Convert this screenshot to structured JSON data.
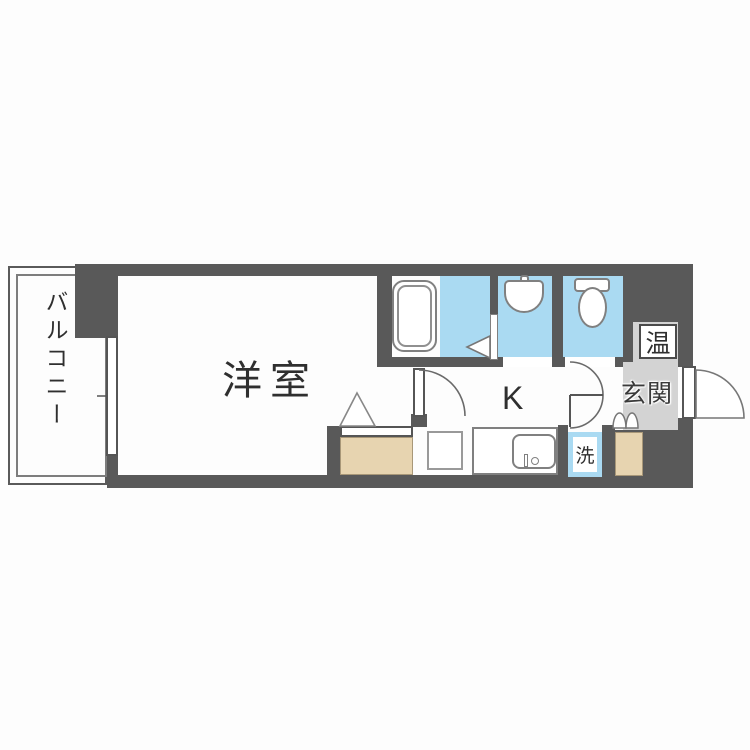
{
  "plan": {
    "type": "japanese-apartment-floorplan",
    "rooms": {
      "balcony_label": "バルコニー",
      "western_room_label": "洋室",
      "kitchen_label": "K",
      "entrance_label": "玄関"
    },
    "fixtures": {
      "water_heater_label": "温",
      "laundry_label": "洗"
    },
    "icons": [
      "bathtub-icon",
      "washbasin-icon",
      "toilet-icon",
      "kitchen-sink-icon",
      "refrigerator-space",
      "folding-door-icon",
      "door-swing-arc",
      "entrance-door-arc",
      "closet-triangle-icon",
      "balcony-window"
    ],
    "colors": {
      "wall": "#595959",
      "wet_area_floor": "#aadaf2",
      "entrance_floor": "#d3d3d3",
      "storage_fill": "#e7d4b0",
      "fixture_outline": "#808080",
      "laundry_pan_border": "#aadaf2",
      "text": "#2f2f2f"
    }
  }
}
